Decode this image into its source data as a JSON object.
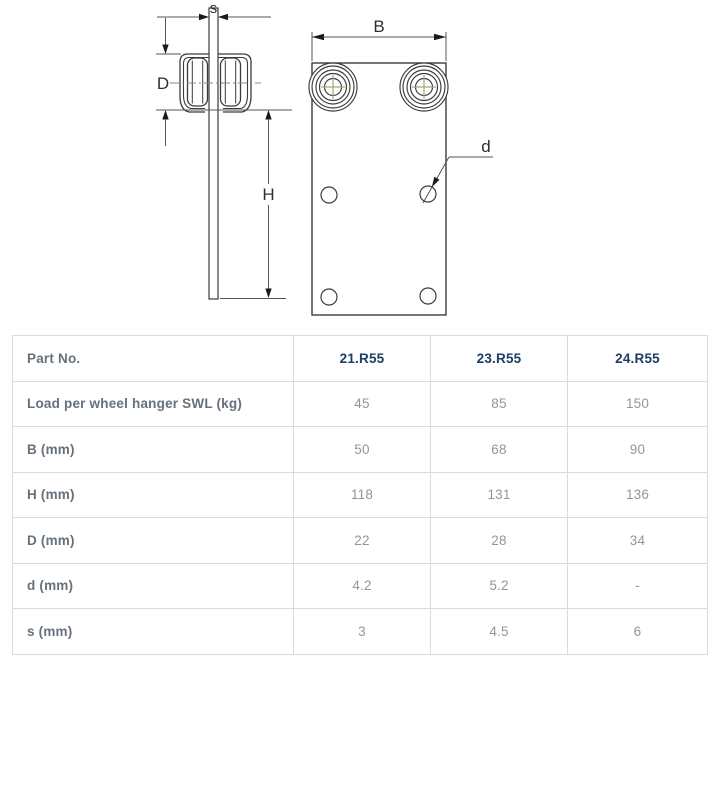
{
  "drawing": {
    "dimension_labels": {
      "s": "s",
      "D": "D",
      "H": "H",
      "B": "B",
      "d": "d"
    },
    "line_color": "#3b3b3b",
    "dim_line_color": "#555555",
    "arrow_color": "#1a1a1a",
    "centerline_color": "#8a8a7a",
    "cross_color": "#a8a874"
  },
  "table": {
    "header_label": "Part No.",
    "part_numbers": [
      "21.R55",
      "23.R55",
      "24.R55"
    ],
    "rows": [
      {
        "label": "Load per wheel hanger SWL (kg)",
        "values": [
          "45",
          "85",
          "150"
        ]
      },
      {
        "label": "B (mm)",
        "values": [
          "50",
          "68",
          "90"
        ]
      },
      {
        "label": "H (mm)",
        "values": [
          "118",
          "131",
          "136"
        ]
      },
      {
        "label": "D (mm)",
        "values": [
          "22",
          "28",
          "34"
        ]
      },
      {
        "label": "d (mm)",
        "values": [
          "4.2",
          "5.2",
          "-"
        ]
      },
      {
        "label": "s (mm)",
        "values": [
          "3",
          "4.5",
          "6"
        ]
      }
    ],
    "colors": {
      "border": "#d9dcdf",
      "label_text": "#67717b",
      "value_text": "#8f979e",
      "part_number_text": "#1c3e63"
    }
  }
}
